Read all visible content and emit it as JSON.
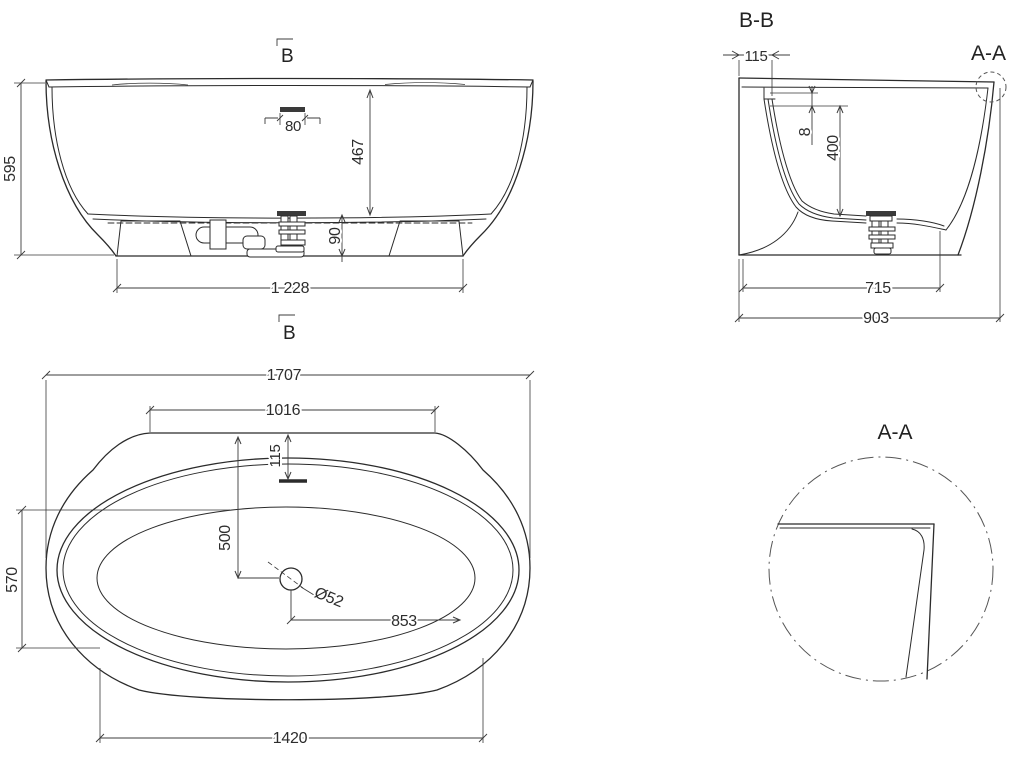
{
  "page": {
    "background": "#ffffff",
    "line_color": "#2b2b2b",
    "dim_text_color": "#2d2d2d"
  },
  "views": {
    "front_elevation": {
      "section_marker_top": "B",
      "section_marker_bottom": "B",
      "dims": {
        "overall_height": "595",
        "inner_depth": "467",
        "overflow_width": "80",
        "base_height": "90",
        "base_length": "1 228"
      }
    },
    "section_bb": {
      "title": "B-B",
      "detail_callout": "A-A",
      "dims": {
        "rim_ledge_width": "115",
        "rim_lip_thickness": "8",
        "basin_depth": "400",
        "base_width": "715",
        "overall_width": "903"
      }
    },
    "plan": {
      "dims": {
        "overall_length": "1707",
        "deck_edge_length": "1016",
        "overflow_offset": "115",
        "drain_offset_from_edge": "500",
        "basin_width": "570",
        "drain_diameter": "Ø52",
        "drain_offset_length": "853",
        "basin_length": "1420"
      }
    },
    "detail_aa": {
      "title": "A-A"
    }
  }
}
